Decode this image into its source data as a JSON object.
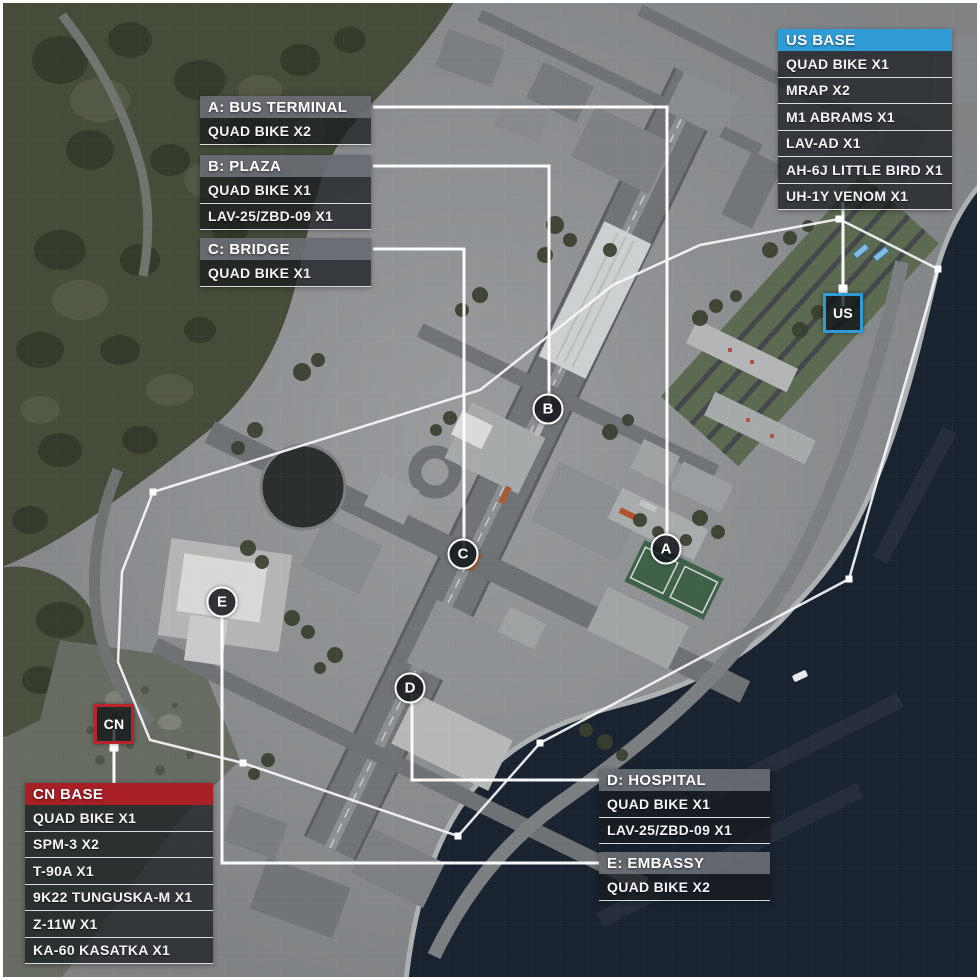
{
  "panels": {
    "us_base": {
      "title": "US BASE",
      "accent": "#2f9cd6",
      "items": [
        "QUAD BIKE X1",
        "MRAP X2",
        "M1 ABRAMS X1",
        "LAV-AD X1",
        "AH-6J LITTLE BIRD X1",
        "UH-1Y VENOM X1"
      ]
    },
    "cn_base": {
      "title": "CN BASE",
      "accent": "#a81f26",
      "items": [
        "QUAD BIKE X1",
        "SPM-3 X2",
        "T-90A X1",
        "9K22 TUNGUSKA-M X1",
        "Z-11W X1",
        "KA-60 KASATKA X1"
      ]
    },
    "flag_a": {
      "title": "A: BUS TERMINAL",
      "items": [
        "QUAD BIKE X2"
      ]
    },
    "flag_b": {
      "title": "B: PLAZA",
      "items": [
        "QUAD BIKE X1",
        "LAV-25/ZBD-09 X1"
      ]
    },
    "flag_c": {
      "title": "C: BRIDGE",
      "items": [
        "QUAD BIKE X1"
      ]
    },
    "flag_d": {
      "title": "D: HOSPITAL",
      "items": [
        "QUAD BIKE X1",
        "LAV-25/ZBD-09 X1"
      ]
    },
    "flag_e": {
      "title": "E: EMBASSY",
      "items": [
        "QUAD BIKE X2"
      ]
    }
  },
  "markers": {
    "us": {
      "label": "US",
      "color": "#2f9cd6"
    },
    "cn": {
      "label": "CN",
      "color": "#b8242b"
    },
    "flags": [
      {
        "letter": "A"
      },
      {
        "letter": "B"
      },
      {
        "letter": "C"
      },
      {
        "letter": "D"
      },
      {
        "letter": "E"
      }
    ]
  },
  "map": {
    "boundary_color": "#f5f7f8",
    "connector_color": "#ffffff",
    "water_color": "#1a2330"
  }
}
